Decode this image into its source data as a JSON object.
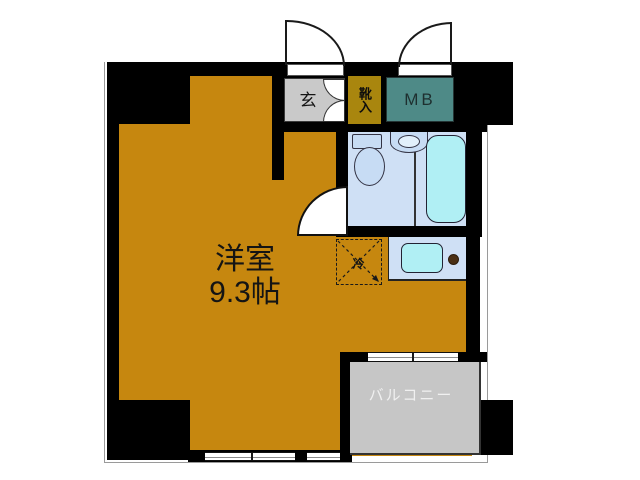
{
  "floor_plan": {
    "main_room": {
      "name": "洋室",
      "area": "9.3帖"
    },
    "entrance": {
      "label": "玄"
    },
    "shoe_cabinet": {
      "label": "靴入"
    },
    "meter_box": {
      "label": "MB"
    },
    "balcony": {
      "label": "バルコニー"
    },
    "refrigerator_space": {
      "label": "冷"
    },
    "colors": {
      "wall": "#000000",
      "main_room_fill": "#C6870F",
      "shoe_cabinet_fill": "#A9860E",
      "entrance_fill": "#C9C9C9",
      "meter_box_fill": "#4E8A87",
      "balcony_fill": "#C6C6C6",
      "bathroom_fill": "#CFE0F5",
      "fixture_fill": "#C7DCF4",
      "bathtub_fill": "#B0EFF4",
      "balcony_text": "#F0F0F0"
    }
  }
}
